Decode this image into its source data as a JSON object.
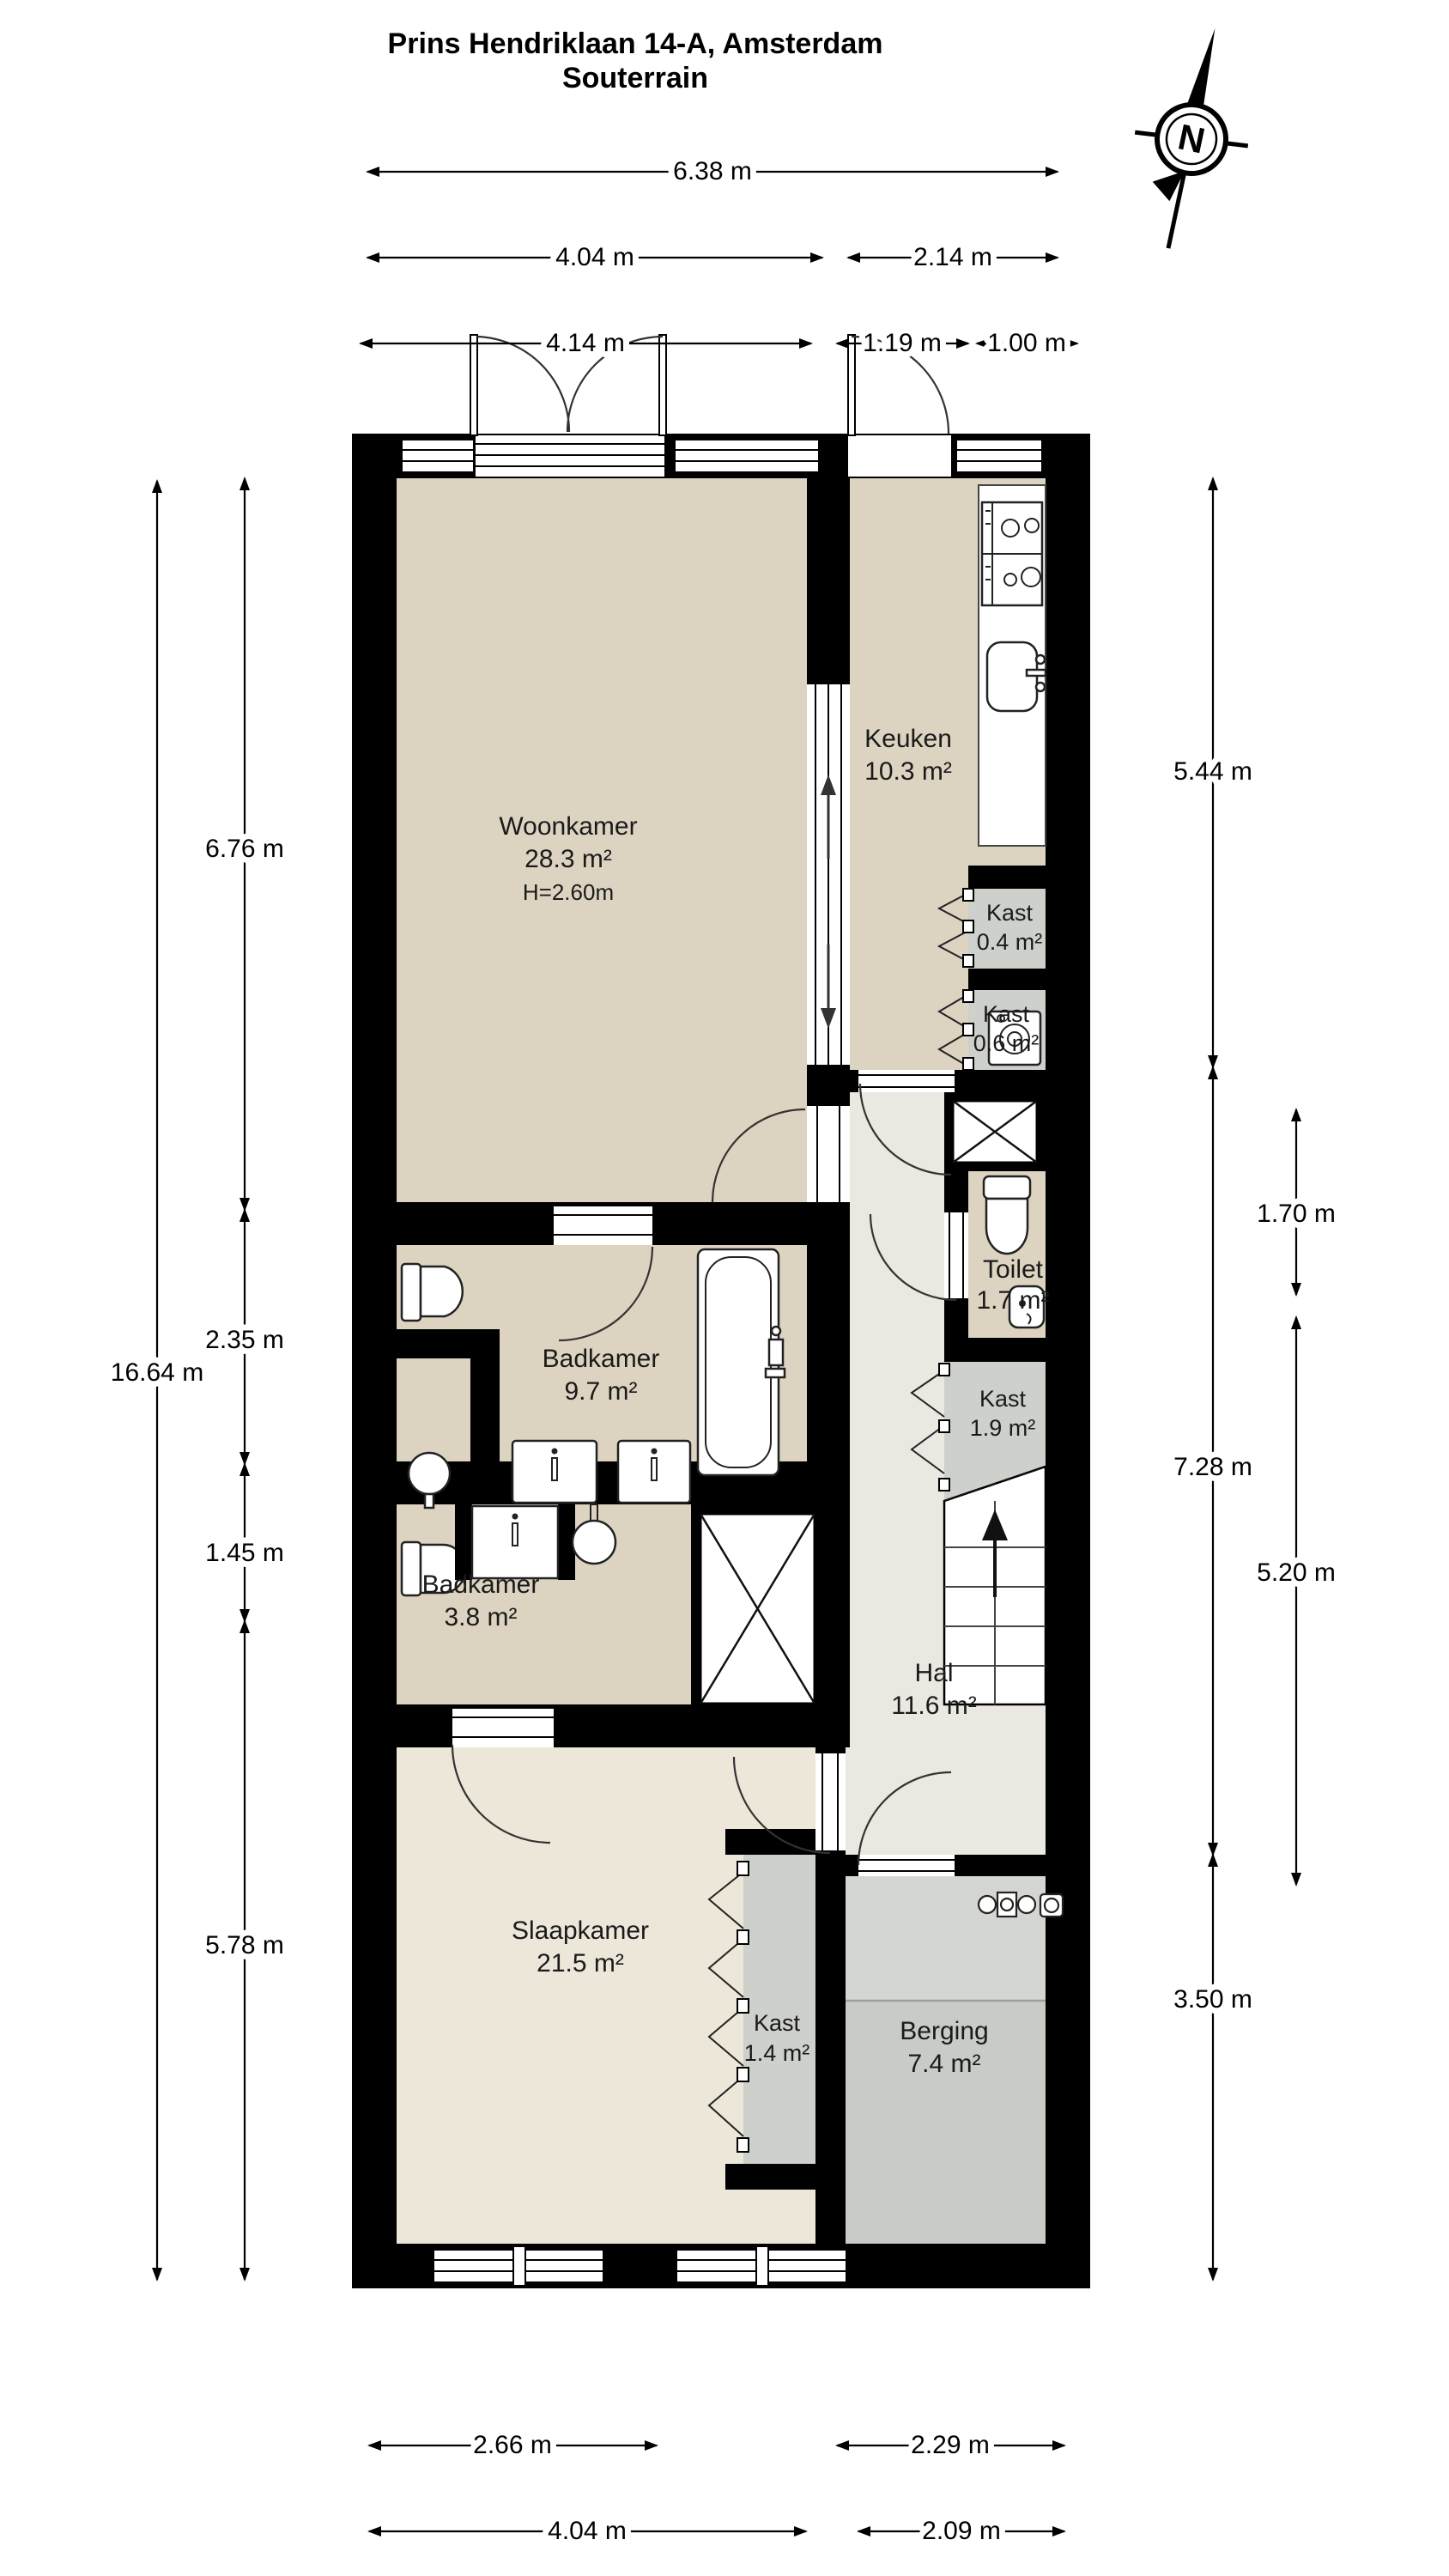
{
  "title": {
    "line1": "Prins Hendriklaan 14-A, Amsterdam",
    "line2": "Souterrain"
  },
  "compass": {
    "label": "N"
  },
  "rooms": {
    "woonkamer": {
      "name": "Woonkamer",
      "area": "28.3 m²",
      "height": "H=2.60m"
    },
    "keuken": {
      "name": "Keuken",
      "area": "10.3 m²"
    },
    "kast_keuken_boven": {
      "name": "Kast",
      "area": "0.4 m²"
    },
    "kast_keuken_onder": {
      "name": "Kast",
      "area": "0.6 m²"
    },
    "toilet": {
      "name": "Toilet",
      "area": "1.7 m²"
    },
    "badkamer_groot": {
      "name": "Badkamer",
      "area": "9.7 m²"
    },
    "kast_hal": {
      "name": "Kast",
      "area": "1.9 m²"
    },
    "badkamer_klein": {
      "name": "Badkamer",
      "area": "3.8 m²"
    },
    "hal": {
      "name": "Hal",
      "area": "11.6 m²"
    },
    "slaapkamer": {
      "name": "Slaapkamer",
      "area": "21.5 m²"
    },
    "kast_slaapkamer": {
      "name": "Kast",
      "area": "1.4 m²"
    },
    "berging": {
      "name": "Berging",
      "area": "7.4 m²"
    }
  },
  "dims": {
    "d6_38": "6.38 m",
    "d4_04": "4.04 m",
    "d2_14": "2.14 m",
    "d4_14": "4.14 m",
    "d1_19": "1.19 m",
    "d1_00": "1.00 m",
    "d16_64": "16.64 m",
    "d6_76": "6.76 m",
    "d2_35": "2.35 m",
    "d1_45": "1.45 m",
    "d5_78": "5.78 m",
    "d5_44": "5.44 m",
    "d1_70": "1.70 m",
    "d7_28": "7.28 m",
    "d5_20": "5.20 m",
    "d3_50": "3.50 m",
    "d2_66": "2.66 m",
    "d2_29": "2.29 m",
    "d2_09": "2.09 m"
  },
  "colors": {
    "wall": "#000000",
    "room_beige": "#ddd3c1",
    "hal": "#ebe8e1",
    "slaapkamer": "#ece7d9",
    "kast_gray": "#cdd0cb",
    "berging_gray": "#c9ccc6"
  }
}
